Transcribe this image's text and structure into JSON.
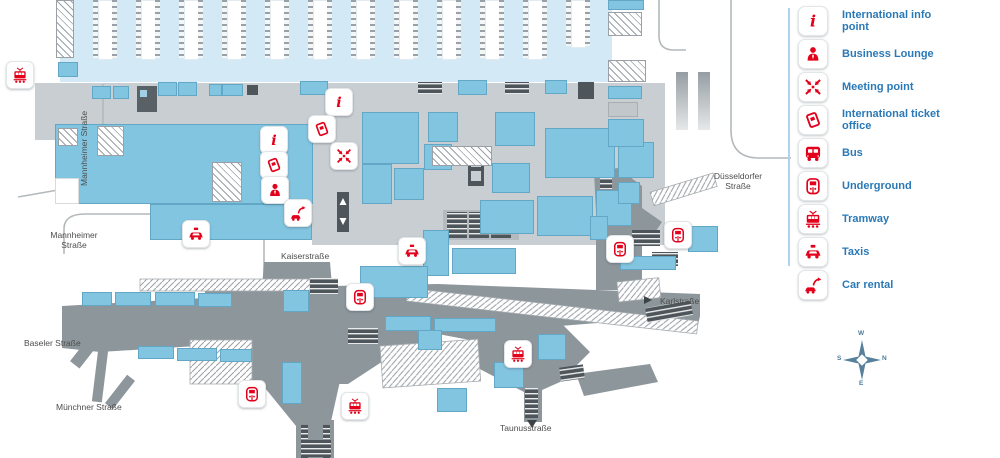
{
  "colors": {
    "accent_red": "#e2001a",
    "track_hall": "#d3e9f6",
    "building_blue": "#82c5e0",
    "concourse_gray": "#c9ced2",
    "underground_gray": "#8d969b",
    "stairs_dark": "#4e565b",
    "label_blue": "#2a79b7",
    "platform_blue": "#3e94c9",
    "street_gray": "#4d4d4d",
    "road_line": "#b4b9bc",
    "legend_divider": "#aed3ea"
  },
  "legend": {
    "items": [
      {
        "icon": "info-icon",
        "label": "International info point"
      },
      {
        "icon": "business-lounge-icon",
        "label": "Business Lounge"
      },
      {
        "icon": "meeting-point-icon",
        "label": "Meeting point"
      },
      {
        "icon": "ticket-office-icon",
        "label": "International ticket office"
      },
      {
        "icon": "bus-icon",
        "label": "Bus"
      },
      {
        "icon": "underground-icon",
        "label": "Underground"
      },
      {
        "icon": "tramway-icon",
        "label": "Tramway"
      },
      {
        "icon": "taxi-icon",
        "label": "Taxis"
      },
      {
        "icon": "car-rental-icon",
        "label": "Car rental"
      }
    ]
  },
  "map": {
    "platform_prefix": "Platform",
    "platforms": [
      "1-2",
      "3-4",
      "5-6",
      "7-8",
      "9-10",
      "11-12",
      "13-14",
      "15-16",
      "17-18",
      "19-20",
      "21-22",
      "23-24"
    ],
    "platform_start_x": 105,
    "platform_spacing": 43,
    "hall": {
      "x": 60,
      "y": 0,
      "w": 552,
      "h": 82
    },
    "streets": [
      {
        "name": "Mannheimer Straße",
        "x": 80,
        "y": 186,
        "rot": -90
      },
      {
        "name": "Mannheimer\nStraße",
        "x": 44,
        "y": 231,
        "w": 60,
        "align": "center"
      },
      {
        "name": "Kaiserstraße",
        "x": 281,
        "y": 252,
        "w": 70,
        "align": "left"
      },
      {
        "name": "Düsseldorfer\nStraße",
        "x": 708,
        "y": 172,
        "w": 60,
        "align": "center"
      },
      {
        "name": "Karlstraße",
        "x": 660,
        "y": 297,
        "w": 60,
        "align": "left"
      },
      {
        "name": "Baseler  Straße",
        "x": 24,
        "y": 339,
        "w": 84,
        "align": "left"
      },
      {
        "name": "Münchner Straße",
        "x": 56,
        "y": 403,
        "w": 92,
        "align": "left"
      },
      {
        "name": "Taunusstraße",
        "x": 500,
        "y": 424,
        "w": 84,
        "align": "left"
      }
    ],
    "icons": [
      {
        "type": "tramway-icon",
        "x": 6,
        "y": 61
      },
      {
        "type": "info-icon",
        "x": 325,
        "y": 88
      },
      {
        "type": "ticket-office-icon",
        "x": 308,
        "y": 115
      },
      {
        "type": "meeting-point-icon",
        "x": 330,
        "y": 142
      },
      {
        "type": "info-icon",
        "x": 260,
        "y": 126
      },
      {
        "type": "ticket-office-icon",
        "x": 260,
        "y": 151
      },
      {
        "type": "business-lounge-icon",
        "x": 261,
        "y": 176
      },
      {
        "type": "car-rental-icon",
        "x": 284,
        "y": 199
      },
      {
        "type": "taxi-icon",
        "x": 182,
        "y": 220
      },
      {
        "type": "taxi-icon",
        "x": 398,
        "y": 237
      },
      {
        "type": "underground-icon",
        "x": 346,
        "y": 283
      },
      {
        "type": "underground-icon",
        "x": 606,
        "y": 235
      },
      {
        "type": "underground-icon",
        "x": 664,
        "y": 221
      },
      {
        "type": "underground-icon",
        "x": 238,
        "y": 380
      },
      {
        "type": "tramway-icon",
        "x": 341,
        "y": 392
      },
      {
        "type": "tramway-icon",
        "x": 504,
        "y": 340
      }
    ],
    "compass": {
      "top": "W",
      "right": "N",
      "left": "S",
      "bottom": "E"
    },
    "blocks": {
      "blue": [
        [
          58,
          62,
          20,
          15
        ],
        [
          92,
          86,
          19,
          13
        ],
        [
          113,
          86,
          16,
          13
        ],
        [
          158,
          82,
          19,
          14
        ],
        [
          178,
          82,
          19,
          14
        ],
        [
          209,
          84,
          13,
          12
        ],
        [
          222,
          84,
          21,
          12
        ],
        [
          300,
          81,
          28,
          14
        ],
        [
          458,
          80,
          29,
          15
        ],
        [
          545,
          80,
          22,
          14
        ],
        [
          55,
          124,
          258,
          80
        ],
        [
          150,
          204,
          162,
          36
        ],
        [
          362,
          112,
          57,
          52
        ],
        [
          362,
          164,
          30,
          40
        ],
        [
          394,
          168,
          30,
          32
        ],
        [
          428,
          112,
          30,
          30
        ],
        [
          424,
          144,
          28,
          26
        ],
        [
          492,
          163,
          38,
          30
        ],
        [
          495,
          112,
          40,
          34
        ],
        [
          545,
          128,
          70,
          50
        ],
        [
          618,
          142,
          36,
          36
        ],
        [
          608,
          0,
          36,
          10
        ],
        [
          608,
          86,
          34,
          13
        ],
        [
          608,
          119,
          36,
          28
        ],
        [
          423,
          230,
          26,
          46
        ],
        [
          452,
          248,
          64,
          26
        ],
        [
          480,
          200,
          54,
          34
        ],
        [
          537,
          196,
          56,
          40
        ],
        [
          596,
          190,
          36,
          36
        ],
        [
          82,
          292,
          30,
          14
        ],
        [
          115,
          292,
          36,
          14
        ],
        [
          155,
          292,
          40,
          14
        ],
        [
          198,
          293,
          34,
          14
        ],
        [
          138,
          346,
          36,
          13
        ],
        [
          177,
          348,
          40,
          13
        ],
        [
          220,
          349,
          32,
          13
        ],
        [
          283,
          290,
          26,
          22
        ],
        [
          282,
          362,
          20,
          42
        ],
        [
          360,
          266,
          68,
          32
        ],
        [
          385,
          316,
          46,
          15
        ],
        [
          434,
          318,
          62,
          14
        ],
        [
          418,
          330,
          24,
          20
        ],
        [
          437,
          388,
          30,
          24
        ],
        [
          494,
          362,
          30,
          26
        ],
        [
          538,
          334,
          28,
          26
        ],
        [
          618,
          182,
          22,
          22
        ],
        [
          590,
          216,
          18,
          24
        ],
        [
          688,
          226,
          30,
          26
        ],
        [
          620,
          256,
          56,
          14
        ]
      ],
      "hatch": [
        [
          56,
          0,
          18,
          58
        ],
        [
          608,
          12,
          34,
          24
        ],
        [
          608,
          60,
          38,
          22
        ],
        [
          58,
          128,
          20,
          18
        ],
        [
          97,
          126,
          27,
          30
        ],
        [
          212,
          162,
          30,
          40
        ],
        [
          432,
          146,
          60,
          20
        ]
      ],
      "gray": [
        [
          608,
          102,
          30,
          15
        ]
      ],
      "white": [
        [
          55,
          178,
          24,
          26
        ]
      ],
      "ramp": [
        [
          676,
          72,
          12,
          58
        ],
        [
          698,
          72,
          12,
          58
        ]
      ]
    }
  }
}
